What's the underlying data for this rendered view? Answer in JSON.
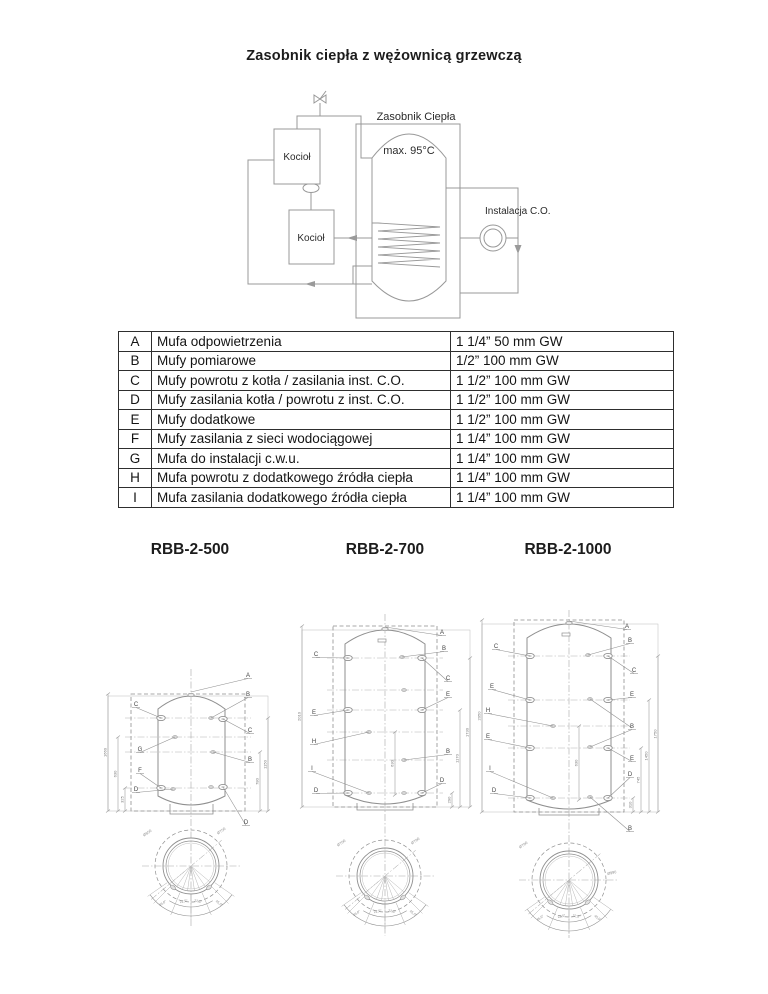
{
  "page": {
    "title": "Zasobnik ciepła z wężownicą grzewczą"
  },
  "schematic": {
    "tank_label": "Zasobnik Ciepła",
    "max_temp": "max. 95°C",
    "boiler_top_label": "Kocioł",
    "boiler_bottom_label": "Kocioł",
    "installation_label": "Instalacja C.O."
  },
  "ports_table": {
    "rows": [
      {
        "code": "A",
        "desc": "Mufa odpowietrzenia",
        "size": "1 1/4” 50 mm GW"
      },
      {
        "code": "B",
        "desc": "Mufy pomiarowe",
        "size": "1/2” 100 mm GW"
      },
      {
        "code": "C",
        "desc": "Mufy powrotu z kotła / zasilania inst. C.O.",
        "size": "1 1/2” 100 mm GW"
      },
      {
        "code": "D",
        "desc": "Mufy zasilania kotła / powrotu z inst. C.O.",
        "size": "1 1/2” 100 mm GW"
      },
      {
        "code": "E",
        "desc": "Mufy dodatkowe",
        "size": "1 1/2” 100 mm GW"
      },
      {
        "code": "F",
        "desc": "Mufy zasilania z sieci wodociągowej",
        "size": "1 1/4” 100 mm GW"
      },
      {
        "code": "G",
        "desc": "Mufa do instalacji c.w.u.",
        "size": "1 1/4” 100 mm GW"
      },
      {
        "code": "H",
        "desc": "Mufa powrotu z dodatkowego źródła ciepła",
        "size": "1 1/4” 100 mm GW"
      },
      {
        "code": "I",
        "desc": "Mufa zasilania dodatkowego źródła ciepła",
        "size": "1 1/4” 100 mm GW"
      }
    ]
  },
  "models": [
    {
      "name": "RBB-2-500",
      "callouts": [
        "A",
        "C",
        "B",
        "C",
        "G",
        "B",
        "F",
        "D",
        "D"
      ],
      "dimensions": [
        "1660",
        "630",
        "325",
        "1150",
        "780"
      ],
      "circle": {
        "diameters": [
          "Ø650",
          "Ø750"
        ],
        "angles": [
          "45,0°",
          "22,5°",
          "22,5°",
          "45,0°"
        ]
      }
    },
    {
      "name": "RBB-2-700",
      "callouts": [
        "A",
        "C",
        "B",
        "C",
        "E",
        "E",
        "H",
        "B",
        "I",
        "D",
        "D"
      ],
      "dimensions": [
        "2010",
        "630",
        "1730",
        "1170",
        "290"
      ],
      "circle": {
        "diameters": [
          "Ø700",
          "Ø790"
        ],
        "angles": [
          "45,0°",
          "22,5°",
          "22,5°",
          "45,0°"
        ]
      }
    },
    {
      "name": "RBB-2-1000",
      "callouts": [
        "A",
        "C",
        "B",
        "C",
        "E",
        "E",
        "H",
        "B",
        "E",
        "E",
        "I",
        "D",
        "D",
        "B"
      ],
      "dimensions": [
        "2050",
        "630",
        "1750",
        "1450",
        "745",
        "310"
      ],
      "circle": {
        "diameters": [
          "Ø790",
          "Ø990"
        ],
        "angles": [
          "45,0°",
          "22,5°",
          "22,5°",
          "45,0°"
        ]
      }
    }
  ],
  "colors": {
    "line": "#8f8f8f",
    "text": "#1c1c1c",
    "table_border": "#2e2e2e"
  }
}
